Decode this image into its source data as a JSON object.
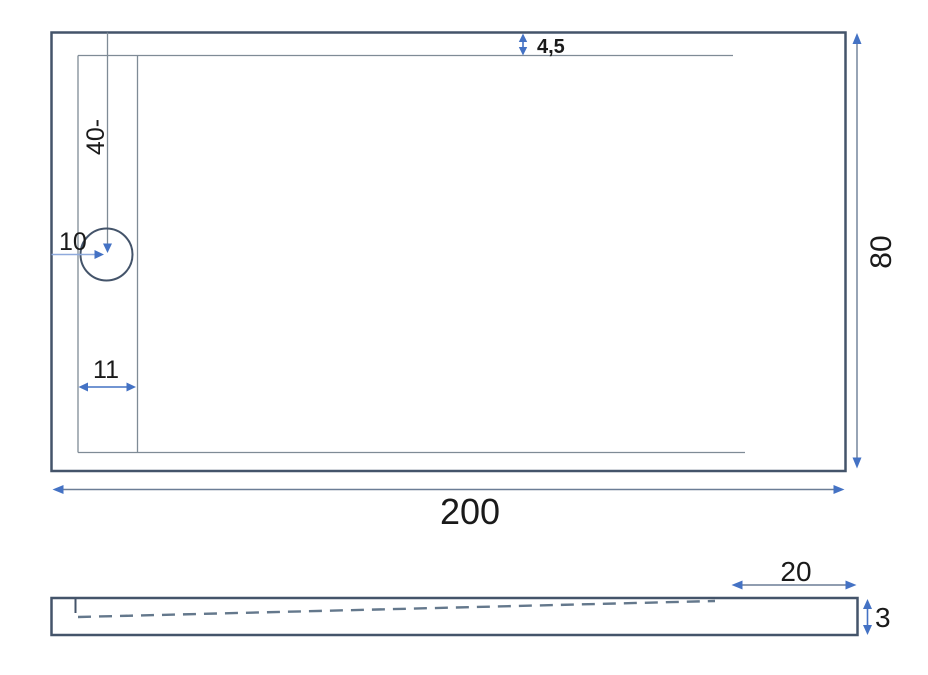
{
  "figure": {
    "description": "Technical dimension drawing of a rectangular shower tray: top view and side profile view",
    "colors": {
      "outline": "#44546A",
      "thin_line": "#7F8B96",
      "dim_line": "#6B7D96",
      "accent_blue": "#4472C4",
      "light_blue": "#8FAADC",
      "dash_line": "#64788C",
      "text": "#1A1A1A",
      "background": "#FFFFFF"
    },
    "top_view": {
      "length_label": "200",
      "width_label": "80",
      "rim_gap_label": "4,5",
      "drain_offset_label": "40-",
      "drain_label": "10",
      "channel_width_label": "11"
    },
    "side_view": {
      "flat_zone_label": "20",
      "thickness_label": "3"
    }
  }
}
